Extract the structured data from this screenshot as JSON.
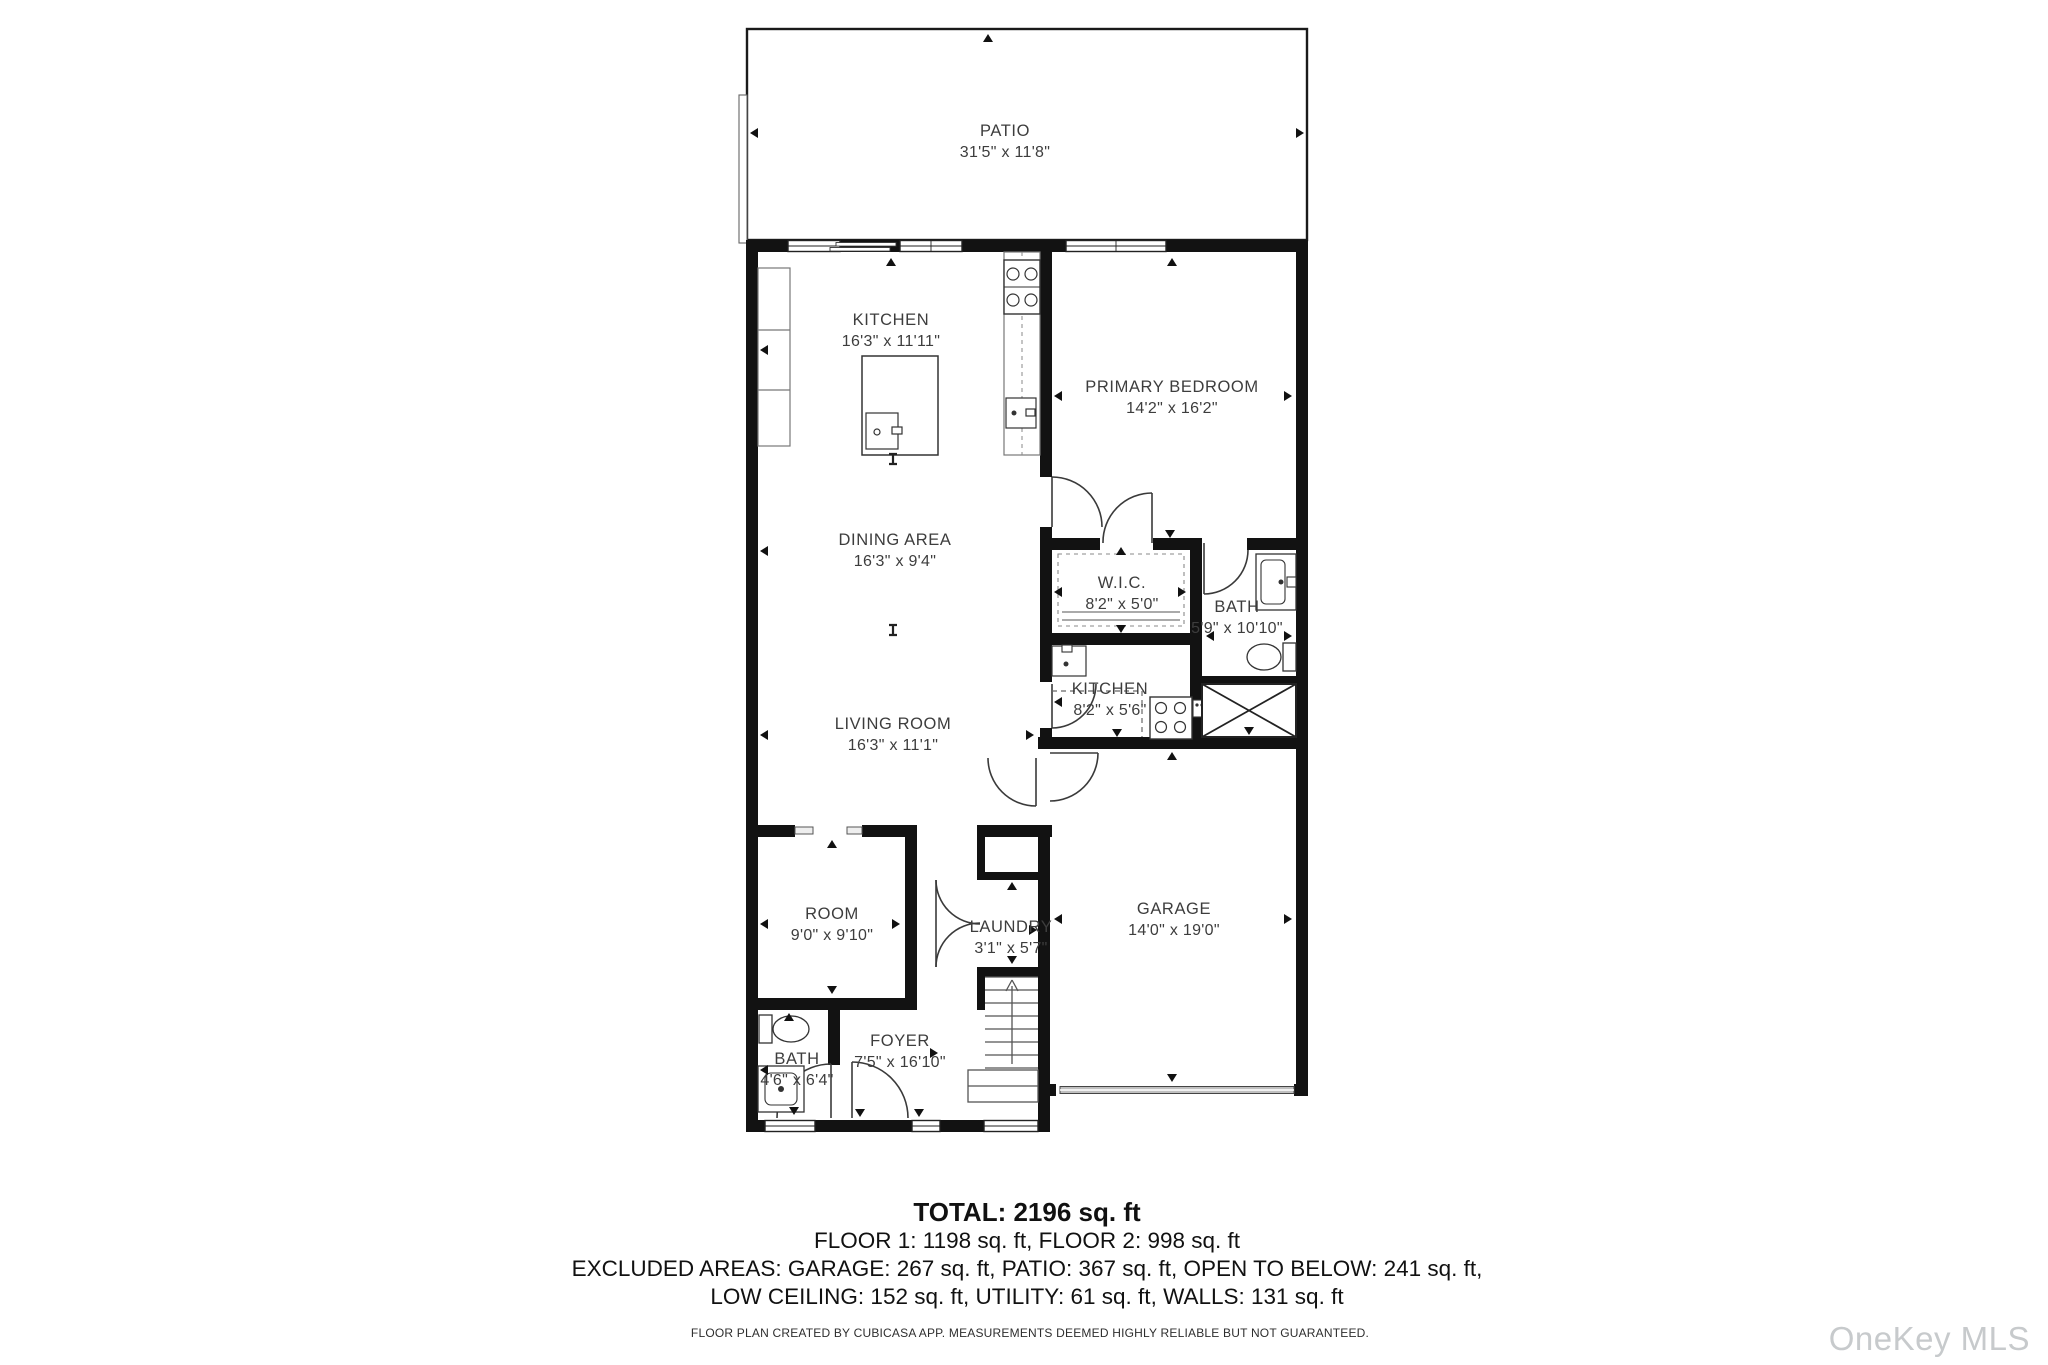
{
  "plan": {
    "wall_color": "#121212",
    "rooms": [
      {
        "id": "patio",
        "name": "PATIO",
        "dims": "31'5\" x 11'8\""
      },
      {
        "id": "kitchen",
        "name": "KITCHEN",
        "dims": "16'3\" x 11'11\""
      },
      {
        "id": "dining-area",
        "name": "DINING AREA",
        "dims": "16'3\" x 9'4\""
      },
      {
        "id": "living-room",
        "name": "LIVING ROOM",
        "dims": "16'3\" x 11'1\""
      },
      {
        "id": "primary-bedroom",
        "name": "PRIMARY BEDROOM",
        "dims": "14'2\" x 16'2\""
      },
      {
        "id": "wic",
        "name": "W.I.C.",
        "dims": "8'2\" x 5'0\""
      },
      {
        "id": "bath-upper",
        "name": "BATH",
        "dims": "5'9\" x 10'10\""
      },
      {
        "id": "kitchen-2",
        "name": "KITCHEN",
        "dims": "8'2\" x 5'6\""
      },
      {
        "id": "room",
        "name": "ROOM",
        "dims": "9'0\" x 9'10\""
      },
      {
        "id": "laundry",
        "name": "LAUNDRY",
        "dims": "3'1\" x 5'7\""
      },
      {
        "id": "garage",
        "name": "GARAGE",
        "dims": "14'0\" x 19'0\""
      },
      {
        "id": "bath-lower",
        "name": "BATH",
        "dims": "4'6\" x 6'4\""
      },
      {
        "id": "foyer",
        "name": "FOYER",
        "dims": "7'5\" x 16'10\""
      }
    ]
  },
  "summary": {
    "total": "TOTAL: 2196 sq. ft",
    "floors": "FLOOR 1: 1198 sq. ft, FLOOR 2: 998 sq. ft",
    "excluded_line1": "EXCLUDED AREAS: GARAGE: 267 sq. ft, PATIO: 367 sq. ft, OPEN TO BELOW: 241 sq. ft,",
    "excluded_line2": "LOW CEILING: 152 sq. ft, UTILITY: 61 sq. ft, WALLS: 131 sq. ft"
  },
  "footer": {
    "disclaimer": "FLOOR PLAN CREATED BY CUBICASA APP. MEASUREMENTS DEEMED HIGHLY RELIABLE BUT NOT GUARANTEED."
  },
  "watermark": {
    "text": "OneKey MLS",
    "color": "#c7cacc"
  }
}
